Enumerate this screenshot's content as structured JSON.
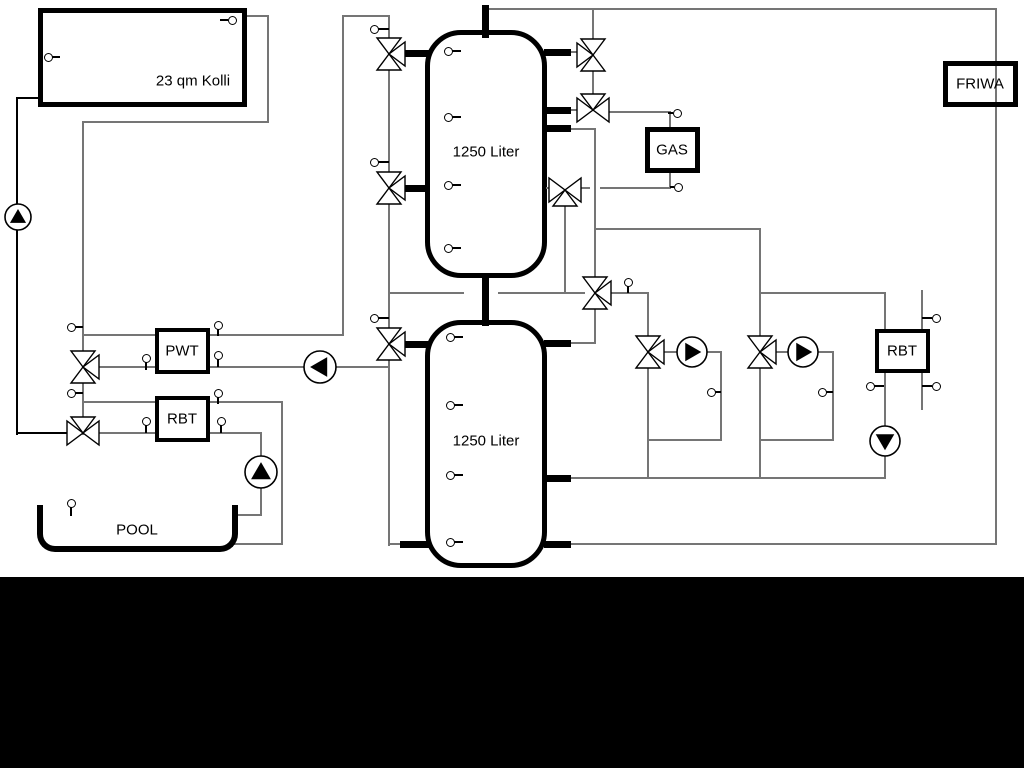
{
  "diagram": {
    "title": "hydraulic-scheme",
    "colors": {
      "line_gray": "#757575",
      "line_black": "#000000",
      "background": "#ffffff",
      "band": "#000000"
    },
    "tanks": [
      {
        "name": "buffer-tank-upper",
        "label": "1250 Liter",
        "x": 425,
        "y": 30,
        "w": 122,
        "h": 248,
        "lx": 486,
        "ly": 152
      },
      {
        "name": "buffer-tank-lower",
        "label": "1250 Liter",
        "x": 425,
        "y": 320,
        "w": 122,
        "h": 248,
        "lx": 486,
        "ly": 441
      }
    ],
    "boxes": [
      {
        "name": "solar-collector",
        "label": "23 qm Kolli",
        "x": 38,
        "y": 8,
        "w": 209,
        "h": 99,
        "b": 5,
        "lx": 193,
        "ly": 81,
        "clear": false
      },
      {
        "name": "gas-boiler",
        "label": "GAS",
        "x": 645,
        "y": 127,
        "w": 55,
        "h": 46,
        "b": 5,
        "lx": 672,
        "ly": 150,
        "clear": false
      },
      {
        "name": "friwa-station",
        "label": "FRIWA",
        "x": 943,
        "y": 61,
        "w": 75,
        "h": 46,
        "b": 5,
        "lx": 980,
        "ly": 84,
        "clear": true
      },
      {
        "name": "pwt-heat-exchanger",
        "label": "PWT",
        "x": 155,
        "y": 328,
        "w": 55,
        "h": 46,
        "b": 4,
        "lx": 182,
        "ly": 351,
        "clear": false
      },
      {
        "name": "rbt-left",
        "label": "RBT",
        "x": 155,
        "y": 396,
        "w": 55,
        "h": 46,
        "b": 4,
        "lx": 182,
        "ly": 419,
        "clear": false
      },
      {
        "name": "rbt-right",
        "label": "RBT",
        "x": 875,
        "y": 329,
        "w": 55,
        "h": 44,
        "b": 4,
        "lx": 902,
        "ly": 351,
        "clear": false
      }
    ],
    "pool": {
      "name": "pool",
      "label": "POOL",
      "x": 37,
      "y": 505,
      "w": 201,
      "h": 47,
      "lx": 137,
      "ly": 530
    },
    "segments": [
      [
        17,
        98,
        38,
        98,
        2,
        "k"
      ],
      [
        17,
        98,
        17,
        434,
        2,
        "k"
      ],
      [
        17,
        433,
        68,
        433,
        2,
        "k"
      ],
      [
        247,
        16,
        268,
        16,
        1.5,
        "g"
      ],
      [
        268,
        16,
        268,
        122,
        1.5,
        "g"
      ],
      [
        83,
        122,
        268,
        122,
        1.5,
        "g"
      ],
      [
        83,
        122,
        83,
        434,
        1.5,
        "g"
      ],
      [
        83,
        335,
        155,
        335,
        1.5,
        "g"
      ],
      [
        210,
        335,
        343,
        335,
        1.5,
        "g"
      ],
      [
        343,
        16,
        343,
        335,
        1.5,
        "g"
      ],
      [
        343,
        16,
        389,
        16,
        1.5,
        "g"
      ],
      [
        389,
        16,
        389,
        545,
        1.5,
        "g"
      ],
      [
        83,
        367,
        155,
        367,
        1.5,
        "g"
      ],
      [
        210,
        367,
        389,
        367,
        1.5,
        "g"
      ],
      [
        83,
        402,
        155,
        402,
        1.5,
        "g"
      ],
      [
        210,
        402,
        282,
        402,
        1.5,
        "g"
      ],
      [
        282,
        402,
        282,
        544,
        1.5,
        "g"
      ],
      [
        234,
        544,
        282,
        544,
        1.5,
        "g"
      ],
      [
        99,
        433,
        155,
        433,
        1.5,
        "g"
      ],
      [
        210,
        433,
        261,
        433,
        1.5,
        "g"
      ],
      [
        261,
        433,
        261,
        515,
        1.5,
        "g"
      ],
      [
        234,
        515,
        261,
        515,
        1.5,
        "g"
      ],
      [
        389,
        293,
        463,
        293,
        1.5,
        "g"
      ],
      [
        499,
        293,
        584,
        293,
        1.5,
        "g"
      ],
      [
        389,
        544,
        403,
        544,
        1.5,
        "g"
      ],
      [
        485,
        9,
        996,
        9,
        1.5,
        "g"
      ],
      [
        996,
        9,
        996,
        544,
        1.5,
        "g"
      ],
      [
        567,
        544,
        996,
        544,
        1.5,
        "g"
      ],
      [
        593,
        9,
        593,
        104,
        1.5,
        "g"
      ],
      [
        567,
        52,
        578,
        52,
        1.5,
        "g"
      ],
      [
        567,
        110,
        579,
        110,
        1.5,
        "g"
      ],
      [
        610,
        112,
        670,
        112,
        1.5,
        "g"
      ],
      [
        670,
        112,
        670,
        127,
        1.5,
        "g"
      ],
      [
        670,
        173,
        670,
        188,
        1.5,
        "g"
      ],
      [
        601,
        188,
        670,
        188,
        1.5,
        "g"
      ],
      [
        581,
        188,
        589,
        188,
        1.5,
        "g"
      ],
      [
        547,
        188,
        550,
        188,
        1.5,
        "g"
      ],
      [
        565,
        204,
        565,
        293,
        1.5,
        "g"
      ],
      [
        567,
        129,
        595,
        129,
        1.5,
        "g"
      ],
      [
        595,
        129,
        595,
        278,
        1.5,
        "g"
      ],
      [
        595,
        229,
        760,
        229,
        1.5,
        "g"
      ],
      [
        760,
        229,
        760,
        337,
        1.5,
        "g"
      ],
      [
        595,
        308,
        595,
        343,
        1.5,
        "g"
      ],
      [
        565,
        343,
        595,
        343,
        1.5,
        "g"
      ],
      [
        611,
        293,
        648,
        293,
        1.5,
        "g"
      ],
      [
        648,
        293,
        648,
        337,
        1.5,
        "g"
      ],
      [
        760,
        293,
        885,
        293,
        1.5,
        "g"
      ],
      [
        885,
        293,
        885,
        329,
        1.5,
        "g"
      ],
      [
        885,
        373,
        885,
        478,
        1.5,
        "g"
      ],
      [
        567,
        478,
        885,
        478,
        1.5,
        "g"
      ],
      [
        664,
        352,
        721,
        352,
        1.5,
        "g"
      ],
      [
        721,
        352,
        721,
        440,
        1.5,
        "g"
      ],
      [
        648,
        440,
        721,
        440,
        1.5,
        "g"
      ],
      [
        648,
        368,
        648,
        478,
        1.5,
        "g"
      ],
      [
        776,
        352,
        833,
        352,
        1.5,
        "g"
      ],
      [
        833,
        352,
        833,
        440,
        1.5,
        "g"
      ],
      [
        760,
        440,
        833,
        440,
        1.5,
        "g"
      ],
      [
        760,
        368,
        760,
        478,
        1.5,
        "g"
      ],
      [
        922,
        291,
        922,
        409,
        1.5,
        "g"
      ],
      [
        403,
        53,
        425,
        53,
        7,
        "k"
      ],
      [
        403,
        188,
        425,
        188,
        7,
        "k"
      ],
      [
        403,
        344,
        425,
        344,
        7,
        "k"
      ],
      [
        403,
        544,
        425,
        544,
        7,
        "k"
      ],
      [
        547,
        52,
        567,
        52,
        7,
        "k"
      ],
      [
        547,
        110,
        567,
        110,
        7,
        "k"
      ],
      [
        547,
        128,
        567,
        128,
        7,
        "k"
      ],
      [
        547,
        343,
        567,
        343,
        7,
        "k"
      ],
      [
        547,
        478,
        567,
        478,
        7,
        "k"
      ],
      [
        547,
        544,
        567,
        544,
        7,
        "k"
      ],
      [
        485,
        8,
        485,
        34,
        7,
        "k"
      ],
      [
        485,
        276,
        485,
        322,
        7,
        "k"
      ]
    ],
    "valves": [
      [
        83,
        367,
        "vr"
      ],
      [
        83,
        433,
        "ht"
      ],
      [
        389,
        54,
        "vr"
      ],
      [
        389,
        188,
        "vr"
      ],
      [
        389,
        344,
        "vr"
      ],
      [
        593,
        55,
        "vl"
      ],
      [
        593,
        110,
        "ht"
      ],
      [
        565,
        190,
        "hb"
      ],
      [
        595,
        293,
        "vr"
      ],
      [
        648,
        352,
        "vr"
      ],
      [
        760,
        352,
        "vr"
      ]
    ],
    "pumps": [
      [
        18,
        217,
        "up",
        13
      ],
      [
        320,
        367,
        "left",
        16
      ],
      [
        261,
        472,
        "up",
        16
      ],
      [
        692,
        352,
        "right",
        15
      ],
      [
        803,
        352,
        "right",
        15
      ],
      [
        885,
        441,
        "down",
        15
      ]
    ],
    "sensors": [
      [
        232,
        20,
        "left",
        8
      ],
      [
        48,
        57,
        "right",
        8
      ],
      [
        374,
        29,
        "right",
        11
      ],
      [
        374,
        162,
        "right",
        11
      ],
      [
        374,
        318,
        "right",
        11
      ],
      [
        448,
        51,
        "right",
        9
      ],
      [
        448,
        117,
        "right",
        9
      ],
      [
        448,
        185,
        "right",
        9
      ],
      [
        448,
        248,
        "right",
        9
      ],
      [
        450,
        337,
        "right",
        9
      ],
      [
        450,
        405,
        "right",
        9
      ],
      [
        450,
        475,
        "right",
        9
      ],
      [
        450,
        542,
        "right",
        9
      ],
      [
        71,
        327,
        "right",
        8
      ],
      [
        71,
        393,
        "right",
        8
      ],
      [
        146,
        358,
        "down",
        8
      ],
      [
        146,
        421,
        "down",
        8
      ],
      [
        218,
        325,
        "down",
        7
      ],
      [
        218,
        355,
        "down",
        8
      ],
      [
        218,
        393,
        "down",
        7
      ],
      [
        221,
        421,
        "down",
        8
      ],
      [
        71,
        503,
        "down",
        9
      ],
      [
        677,
        113,
        "left",
        5
      ],
      [
        678,
        187,
        "left",
        4
      ],
      [
        628,
        282,
        "down",
        7
      ],
      [
        711,
        392,
        "right",
        6
      ],
      [
        822,
        392,
        "right",
        7
      ],
      [
        936,
        318,
        "left",
        10
      ],
      [
        936,
        386,
        "left",
        10
      ],
      [
        870,
        386,
        "right",
        10
      ]
    ],
    "band": {
      "y": 577,
      "h": 191
    }
  }
}
